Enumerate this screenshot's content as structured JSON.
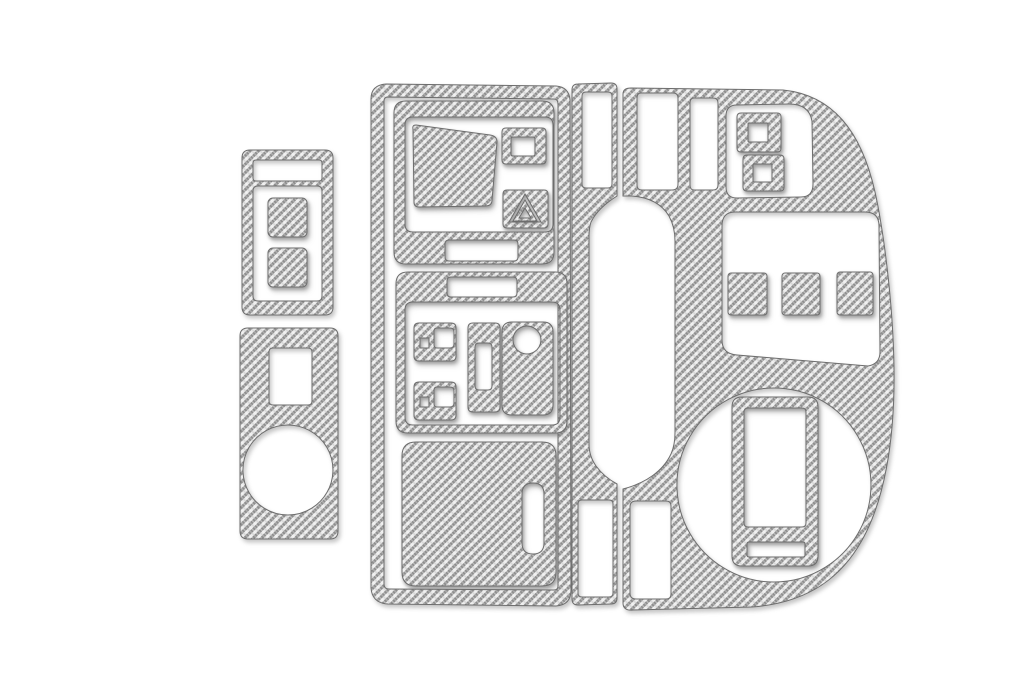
{
  "photo": {
    "description": "Carbon fiber dashboard trim kit pieces photographed on a white background",
    "piece_count": 5,
    "background_color": "#ffffff"
  },
  "palette": {
    "weave_light": "#ebebeb",
    "weave_dark": "#8d8d8d",
    "weave_cross": "#c6c6c6",
    "weave_highlight": "#ffffff",
    "edge": "#6d6d6d"
  },
  "pieces": [
    {
      "id": "switch-panel-upper-left",
      "desc": "small rectangular panel with top slot and two square button inserts"
    },
    {
      "id": "panel-lower-left",
      "desc": "tall panel with rectangular opening and large round cutout"
    },
    {
      "id": "center-stack-panel",
      "desc": "large center panel with display opening, square vent ring, hazard triangle button, climate controls and storage door with pull handle"
    },
    {
      "id": "console-left-strip",
      "desc": "narrow console strip with upper and lower rectangular openings beside the shifter arch"
    },
    {
      "id": "dashboard-right-panel",
      "desc": "large curved panel with two slots, stacked button rings, three button squares in a wide opening, shifter arch and round gauge cutout with inner frame"
    }
  ]
}
